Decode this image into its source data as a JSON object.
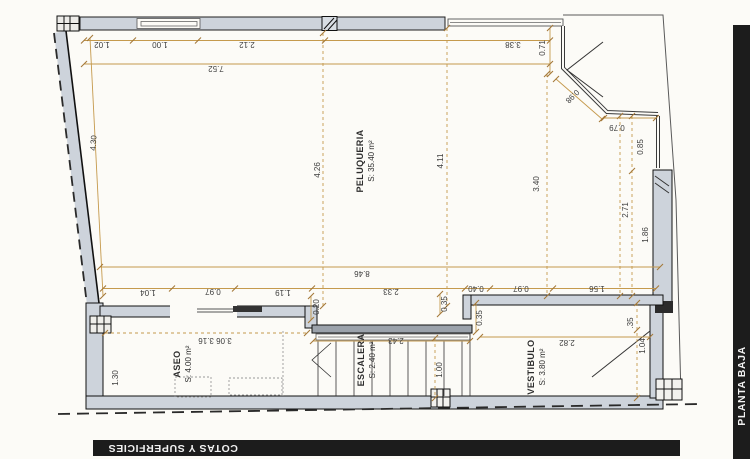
{
  "plan": {
    "rooms": {
      "peluqueria": {
        "name": "PELUQUERIA",
        "area": "S: 35.40 m²"
      },
      "aseo": {
        "name": "ASEO",
        "area": "S: 4.00 m²"
      },
      "escalera": {
        "name": "ESCALERA",
        "area": "S: 2.40 m²"
      },
      "vestibulo": {
        "name": "VESTIBULO",
        "area": "S: 3.80 m²"
      }
    },
    "dims": {
      "top_1": "1.02",
      "top_2": "1.00",
      "top_3": "2.12",
      "top_4": "3.38",
      "top_total": "7.52",
      "chamfer_v": "0.71",
      "chamfer_d": "0.98",
      "chamfer_h": "0.79",
      "right_upper": "0.85",
      "right_total": "2.71",
      "right_lower": "1.86",
      "mid_left": "4.26",
      "mid_center": "4.11",
      "mid_right": "3.40",
      "left_slant": "4.30",
      "width_total": "8.46",
      "bot_1": "1.04",
      "bot_2": "0.97",
      "bot_3": "1.19",
      "bot_4": "2.33",
      "bot_5": "0.40",
      "bot_6": "0.97",
      "bot_7": "1.56",
      "step_v": "0.20",
      "step_v2": "0.35",
      "vest_step": "0.35",
      "aseo_h": "1.30",
      "aseo_w": "3.06 3.16",
      "stair_w": "2.43",
      "stair_v": "1.00",
      "vest_w": "2.82",
      "vest_v1": ".35",
      "vest_v2": "1.04"
    },
    "titles": {
      "cotas": "COTAS Y SUPERFICIES",
      "planta": "PLANTA BAJA"
    },
    "colors": {
      "dim_line": "#c59a4d",
      "tick": "#a5793a",
      "wall_fill": "#cdd3db",
      "bar_bg": "#1c1c1c"
    }
  }
}
